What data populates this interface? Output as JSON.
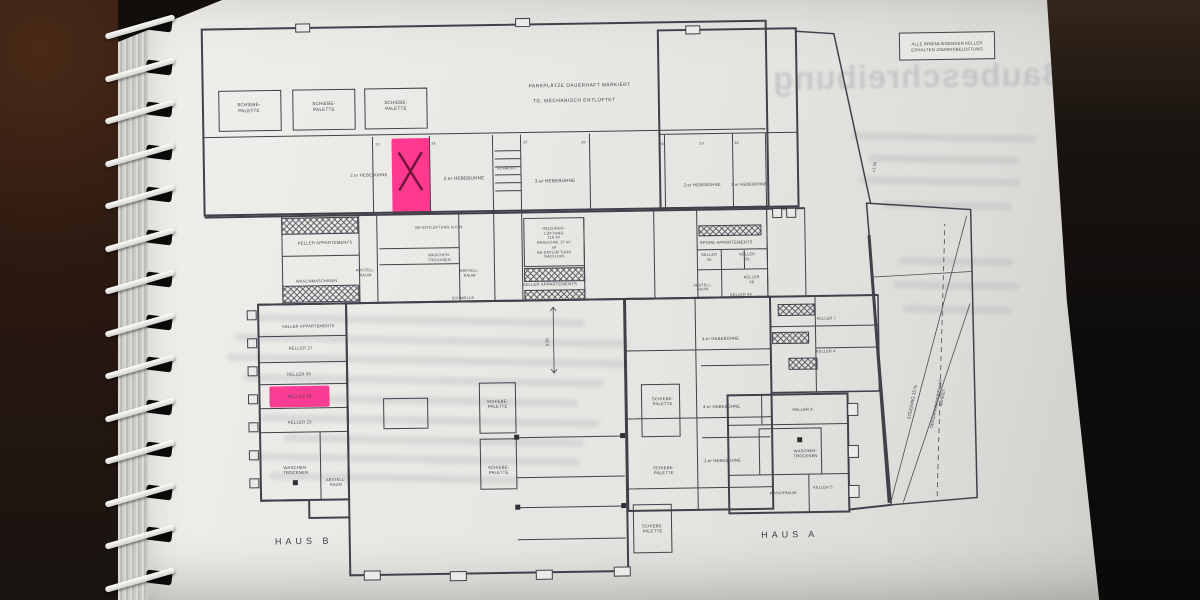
{
  "photo": {
    "background": "#171310",
    "paper": "#e9e8e4"
  },
  "colors": {
    "ink": "#41414b",
    "highlight_pink": "#ff2b88",
    "highlight_pink_left": "#fb2e8d",
    "x_mark": "#5c0e2c",
    "ghost": "#b1b4b9"
  },
  "title": {
    "line1": "PARKPLÄTZE DAUERHAFT MARKIERT",
    "line2": "TG. MECHANISCH ENTLÜFTET"
  },
  "note_box": {
    "line1": "ALLE INNENLIEGENDEN KELLER",
    "line2": "ERHALTEN ZWANGSBELÜFTUNG"
  },
  "bleed": {
    "heading": "Baubeschreibung"
  },
  "houses": {
    "haus_b": "HAUS B",
    "haus_a": "HAUS A"
  },
  "ramp": {
    "text1": "STEIGUNG 15 %",
    "text2": "TIEFGARAGENEINFAHRT",
    "text3": "BEHEIZT"
  },
  "dimension": {
    "value": "5.50"
  },
  "labels": [
    {
      "t": "SCHIEBE-\nPALETTE",
      "x": 252,
      "y": 103
    },
    {
      "t": "SCHIEBE-\nPALETTE",
      "x": 327,
      "y": 103
    },
    {
      "t": "SCHIEBE-\nPALETTE",
      "x": 399,
      "y": 103
    },
    {
      "t": "2.er HEBEBÜHNE",
      "x": 371,
      "y": 172,
      "fs": 4.2
    },
    {
      "t": "2.er HEBEBÜHNE",
      "x": 466,
      "y": 177
    },
    {
      "t": "3.er HEBEBÜHNE",
      "x": 557,
      "y": 181
    },
    {
      "t": "2.er HEBEBÜHNE",
      "x": 704,
      "y": 187,
      "fs": 4.2
    },
    {
      "t": "2.er HEBEBÜHNE",
      "x": 751,
      "y": 187,
      "fs": 4
    },
    {
      "t": "SCHACHT",
      "x": 509,
      "y": 168,
      "fs": 3.8
    },
    {
      "t": "BE-ENTLÜFTUNG N.DIN",
      "x": 440,
      "y": 226,
      "fs": 3.8
    },
    {
      "t": "KELLER APPARTEMENTS",
      "x": 326,
      "y": 239,
      "fs": 4.2
    },
    {
      "t": "WASCHEN-\nTROCKNEN",
      "x": 440,
      "y": 256,
      "fs": 3.8
    },
    {
      "t": "WASCHMASCHINEN",
      "x": 317,
      "y": 277,
      "fs": 4
    },
    {
      "t": "ABSTELL-\nRAUM",
      "x": 366,
      "y": 270,
      "fs": 3.8
    },
    {
      "t": "ABSTELL-\nRAUM",
      "x": 470,
      "y": 272,
      "fs": 3.8
    },
    {
      "t": "HEIZUNGS-\nLÜFTUNG\n118 m²\nBRAUCHW. 37 m²\n±0\nBE-ENTLÜFTUNG\nNACH DIN",
      "x": 555,
      "y": 243,
      "fs": 3.8
    },
    {
      "t": "KELLER APPARTEMENTS",
      "x": 550,
      "y": 284,
      "fs": 4.2
    },
    {
      "t": "SPORE APPARTEMENTS",
      "x": 727,
      "y": 245,
      "fs": 4.2
    },
    {
      "t": "KELLER\n56",
      "x": 710,
      "y": 260,
      "fs": 3.8
    },
    {
      "t": "KELLER\n59",
      "x": 748,
      "y": 260,
      "fs": 3.8
    },
    {
      "t": "KELLER\n58",
      "x": 752,
      "y": 283,
      "fs": 3.8
    },
    {
      "t": "ABSTELL-\nRAUM",
      "x": 703,
      "y": 290,
      "fs": 3.6
    },
    {
      "t": "KELLER 58",
      "x": 741,
      "y": 298,
      "fs": 3.8
    },
    {
      "t": "SCHWELLE",
      "x": 463,
      "y": 297,
      "fs": 3.8
    },
    {
      "t": "KELLER APPARTEMENTS",
      "x": 308,
      "y": 322,
      "fs": 4
    },
    {
      "t": "KELLER 27",
      "x": 300,
      "y": 344,
      "fs": 4.2
    },
    {
      "t": "KELLER 30",
      "x": 298,
      "y": 370,
      "fs": 4.2
    },
    {
      "t": "KELLER 29",
      "x": 298,
      "y": 392,
      "fs": 4.2
    },
    {
      "t": "KELLER 23",
      "x": 298,
      "y": 418,
      "fs": 4.2
    },
    {
      "t": "WASCHEN-\nTROCKNEN",
      "x": 293,
      "y": 466,
      "fs": 4.2
    },
    {
      "t": "ABSTELL-\nRAUM",
      "x": 333,
      "y": 479,
      "fs": 3.8
    },
    {
      "t": "SCHIEBE-\nPALETTE",
      "x": 496,
      "y": 403,
      "fs": 4.2
    },
    {
      "t": "SCHIEBE-\nPALETTE",
      "x": 496,
      "y": 469,
      "fs": 4.2
    },
    {
      "t": "4.er HEBEBÜHNE",
      "x": 720,
      "y": 341,
      "fs": 4.2
    },
    {
      "t": "SCHIEBE-\nPALETTE",
      "x": 661,
      "y": 403,
      "fs": 4.2
    },
    {
      "t": "4.er HEBEBÜHNE",
      "x": 720,
      "y": 409,
      "fs": 4.2
    },
    {
      "t": "1.er HEBEBÜHNE",
      "x": 720,
      "y": 463,
      "fs": 4.2
    },
    {
      "t": "SCHIEBE-\nPALETTE",
      "x": 661,
      "y": 472,
      "fs": 4.2
    },
    {
      "t": "SCHIEBE-\nPALETTE",
      "x": 649,
      "y": 530,
      "fs": 4.2
    },
    {
      "t": "KELLER 7",
      "x": 826,
      "y": 323,
      "fs": 3.8
    },
    {
      "t": "KELLER 4",
      "x": 825,
      "y": 356,
      "fs": 3.8
    },
    {
      "t": "KELLER A",
      "x": 801,
      "y": 413,
      "fs": 4
    },
    {
      "t": "WASCHEN-\nTROCKNEN",
      "x": 803,
      "y": 457,
      "fs": 4
    },
    {
      "t": "WASCHRAUM",
      "x": 780,
      "y": 497,
      "fs": 3.8
    },
    {
      "t": "KELLER 5",
      "x": 820,
      "y": 492,
      "fs": 3.8
    },
    {
      "t": "23",
      "x": 380,
      "y": 142,
      "fs": 3.6
    },
    {
      "t": "24",
      "x": 436,
      "y": 142,
      "fs": 3.6
    },
    {
      "t": "25",
      "x": 528,
      "y": 142,
      "fs": 3.6
    },
    {
      "t": "26",
      "x": 586,
      "y": 143,
      "fs": 3.6
    },
    {
      "t": "28",
      "x": 664,
      "y": 146,
      "fs": 3.6
    },
    {
      "t": "29",
      "x": 704,
      "y": 146,
      "fs": 3.6
    },
    {
      "t": "30",
      "x": 739,
      "y": 146,
      "fs": 3.6
    },
    {
      "t": "±2.50",
      "x": 877,
      "y": 172,
      "fs": 3.8,
      "rot": -80
    }
  ]
}
